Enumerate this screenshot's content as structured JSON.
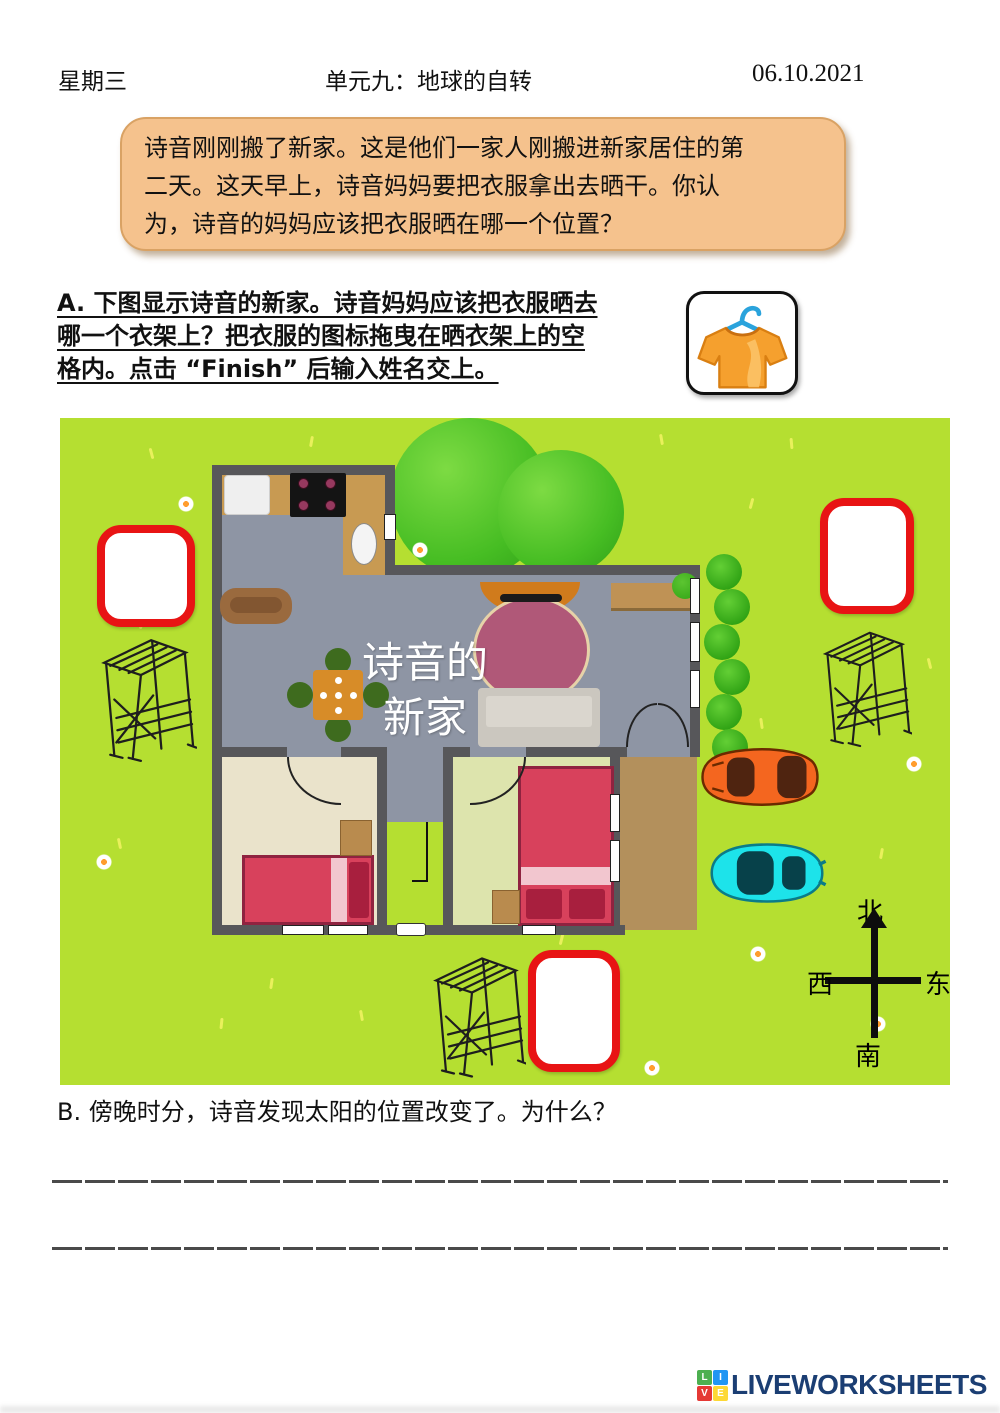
{
  "header": {
    "day": "星期三",
    "unit_title": "单元九：地球的自转",
    "date": "06.10.2021"
  },
  "intro_bubble": {
    "lines": [
      "诗音刚刚搬了新家。这是他们一家人刚搬进新家居住的第",
      "二天。这天早上，诗音妈妈要把衣服拿出去晒干。你认",
      "为，诗音的妈妈应该把衣服晒在哪一个位置？"
    ]
  },
  "section_a": {
    "lines": [
      "A. 下图显示诗音的新家。诗音妈妈应该把衣服晒去",
      "哪一个衣架上？把衣服的图标拖曳在晒衣架上的空",
      "格内。点击 “Finish” 后输入姓名交上。"
    ]
  },
  "map": {
    "house_label": [
      "诗音的",
      "新家"
    ],
    "compass": {
      "north": "北",
      "south": "南",
      "west": "西",
      "east": "东"
    },
    "drop_zone_count": 3,
    "icons": {
      "draggable": "tshirt-on-hanger-icon",
      "rack": "clothes-drying-rack-icon",
      "compass": "compass-cross-icon"
    },
    "colors": {
      "grass": "#b5df31",
      "drop_zone_border": "#e81414",
      "wall": "#57575a",
      "orange_car": "#f4661f",
      "cyan_car": "#1de3ea"
    }
  },
  "section_b": {
    "text": "B. 傍晚时分，诗音发现太阳的位置改变了。为什么？"
  },
  "answer_lines": {
    "count": 2
  },
  "footer": {
    "brand": "LIVEWORKSHEETS",
    "tiles": [
      {
        "letter": "L",
        "color": "#4caf50"
      },
      {
        "letter": "I",
        "color": "#2196f3"
      },
      {
        "letter": "V",
        "color": "#e53935"
      },
      {
        "letter": "E",
        "color": "#fdd835"
      }
    ]
  }
}
